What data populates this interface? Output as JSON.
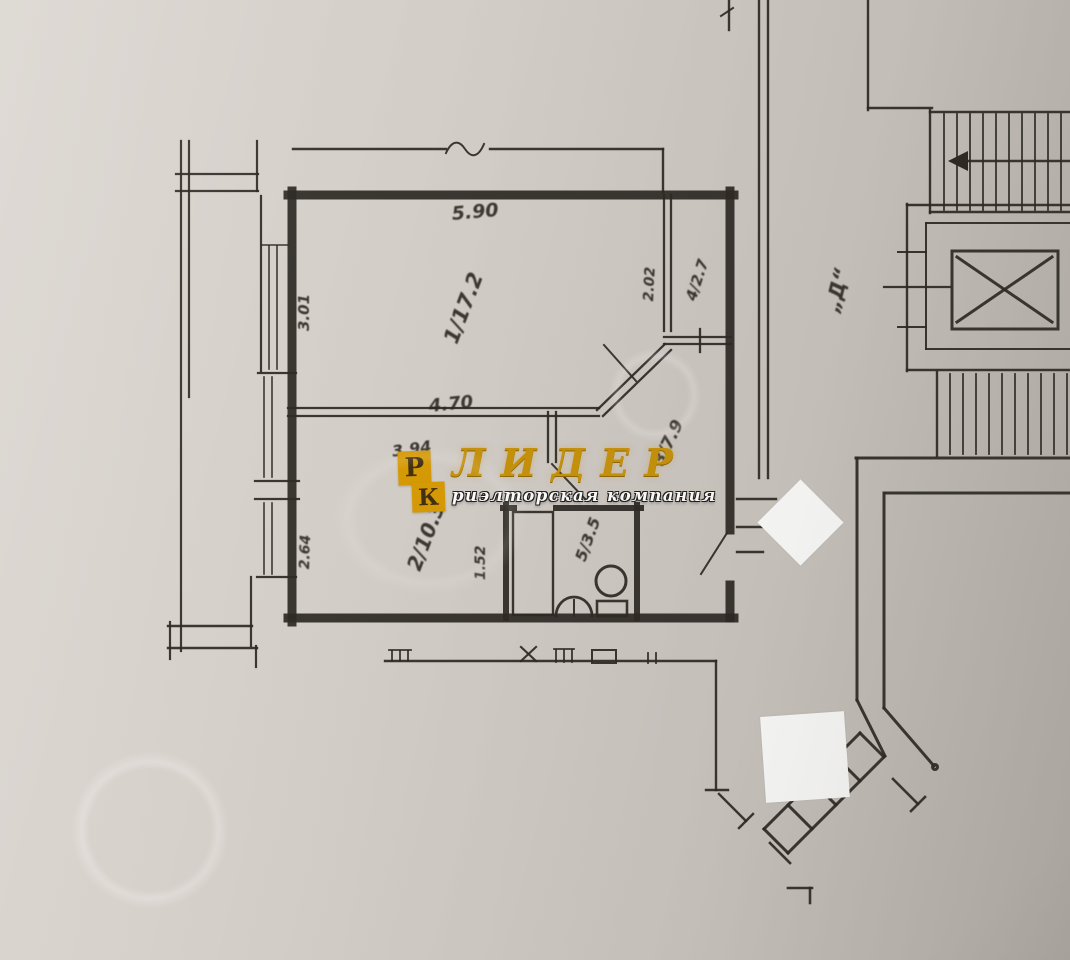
{
  "watermark": {
    "logo_top_letter": "Р",
    "logo_bottom_letter": "К",
    "brand": "ЛИДЕР",
    "tagline": "риэлторская компания"
  },
  "plan": {
    "rooms": [
      {
        "number": "1",
        "area_m2": "17.2",
        "label": "1/17.2"
      },
      {
        "number": "2",
        "area_m2": "10.3",
        "label": "2/10.3"
      },
      {
        "number": "3",
        "area_m2": "7.9",
        "label": "3/7.9"
      },
      {
        "number": "4",
        "area_m2": "2.7",
        "label": "4/2.7"
      },
      {
        "number": "5",
        "area_m2": "3.5",
        "label": "5/3.5"
      }
    ],
    "dimensions_m": {
      "room1_top": "5.90",
      "room1_left": "3.01",
      "room1_bottom": "4.70",
      "room4_left": "2.02",
      "room2_top": "3.94",
      "room2_left": "2.64",
      "bathroom_left": "1.52"
    },
    "stairwell_label": "„Д“"
  },
  "colors": {
    "paper": "#d3cdc7",
    "ink": "#2e2b26",
    "gold": "#c8930c",
    "logo_tile": "#d79b05"
  }
}
